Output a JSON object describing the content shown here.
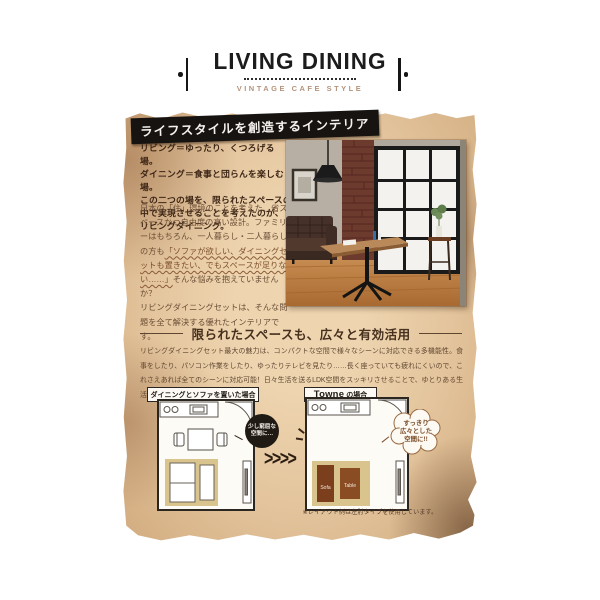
{
  "header": {
    "title": "LIVING DINING",
    "subtitle": "VINTAGE CAFE STYLE"
  },
  "banner": "ライフスタイルを創造するインテリア",
  "intro": {
    "lead": "リビング＝ゆったり、くつろげる場。\nダイニング＝食事と団らんを楽しむ場。\nこの二つの場を、限られたスペースの\n中で実現させることを考えたのが、\nリビングダイニング。",
    "body_before": "日本の「住」環境のことを考えた、省スペースかつ自由度の高い設計。ファミリーはもちろん、一人暮らし・二人暮らしの方も",
    "body_quote": "「ソファが欲しい、ダイニングセットも置きたい、でもスペースが足りない……」",
    "body_after": "そんな悩みを抱えていませんか？\nリビングダイニングセットは、そんな問題を全て解決する優れたインテリアです。"
  },
  "section": {
    "heading": "限られたスペースも、広々と有効活用",
    "body": "リビングダイニングセット最大の魅力は、コンパクトな空間で様々なシーンに対応できる多機能性。食事をしたり、パソコン作業をしたり、ゆったりテレビを見たり……長く座っていても疲れにくいので、これさえあれば全てのシーンに対応可能！日々生活を送るLDK空間をスッキリさせることで、ゆとりある生活に。"
  },
  "plans": {
    "left_label": "ダイニングとソファを置いた場合",
    "right_label_brand": "Towne",
    "right_label_suffix": "の場合",
    "left_badge": "少し窮屈な\n空間に…",
    "right_bubble": "すっきり\n広々とした\n空間に!!",
    "sofa_label": "Sofa",
    "table_label": "Table",
    "arrows": ">>>>",
    "footnote": "※レイアウト例は左肘タイプを使用しています。"
  },
  "colors": {
    "paper": "#e3c49c",
    "wood": "#2a1c12",
    "banner_bg": "#171310",
    "text_brown": "#6b4e36",
    "rug": "#d9c48e",
    "sofa_brown": "#7c3f1d",
    "table_brown": "#8a4c22",
    "subtitle_tan": "#b5937c"
  }
}
